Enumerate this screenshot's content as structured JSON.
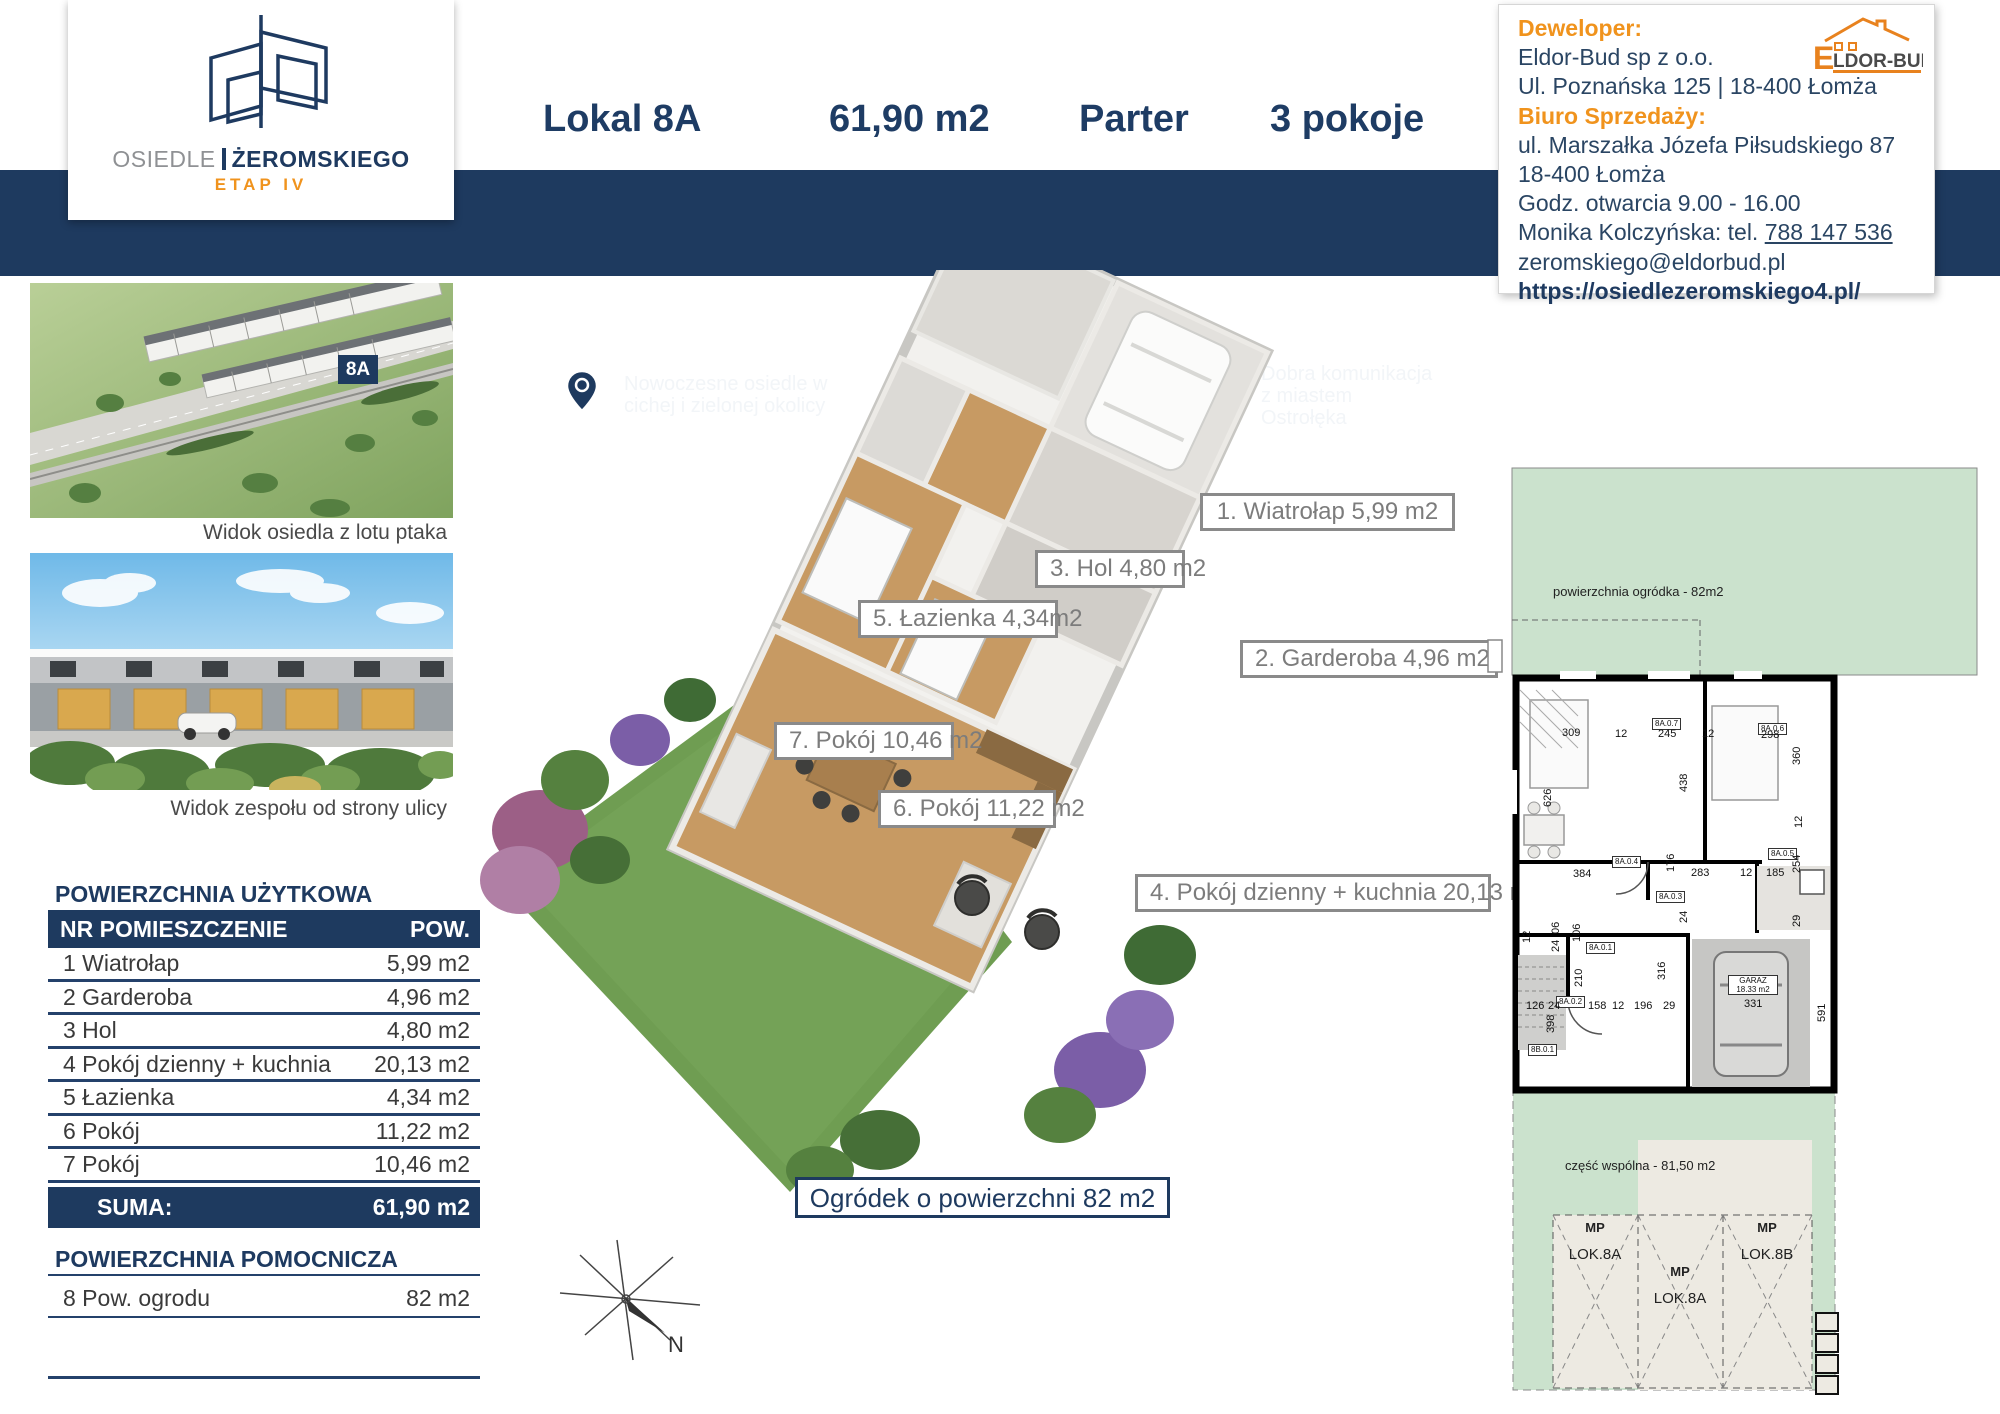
{
  "logo": {
    "line_gray": "OSIEDLE",
    "line_navy": "ŻEROMSKIEGO",
    "etap": "ETAP IV"
  },
  "header": {
    "lokal": "Lokal 8A",
    "area": "61,90 m2",
    "floor": "Parter",
    "rooms": "3 pokoje"
  },
  "features": [
    {
      "icon": "location-pin-icon",
      "text": "Nowoczesne osiedle w cichej i zielonej okolicy"
    },
    {
      "icon": "floorplan-icon",
      "text": "Zróżnicowane warianty lokali"
    },
    {
      "icon": "building-icon",
      "text": "Dobra komunikacja z miastem Ostrołęka"
    }
  ],
  "developer_box": {
    "dev_label": "Deweloper:",
    "dev_name": "Eldor-Bud  sp z o.o.",
    "dev_address": "Ul. Poznańska 125 | 18-400 Łomża",
    "office_label": "Biuro Sprzedaży:",
    "office_address1": "ul. Marszałka Józefa Piłsudskiego 87",
    "office_address2": "18-400 Łomża",
    "hours": "Godz. otwarcia 9.00 - 16.00",
    "contact_prefix": "Monika Kolczyńska: tel. ",
    "phone": "788 147 536",
    "email": " zeromskiego@eldorbud.pl",
    "website": "https://osiedlezeromskiego4.pl/",
    "brand_e": "E",
    "brand_rest": "LDOR-BUD"
  },
  "photos": {
    "badge": "8A",
    "caption1": "Widok osiedla z lotu ptaka",
    "caption2": "Widok zespołu od strony ulicy"
  },
  "area_table": {
    "title": "POWIERZCHNIA UŻYTKOWA",
    "col_nr": "NR POMIESZCZENIE",
    "col_pow": "POW.",
    "rows": [
      {
        "name": "1 Wiatrołap",
        "pow": "5,99 m2"
      },
      {
        "name": "2 Garderoba",
        "pow": "4,96 m2"
      },
      {
        "name": "3 Hol",
        "pow": "4,80 m2"
      },
      {
        "name": "4  Pokój dzienny + kuchnia",
        "pow": "20,13 m2"
      },
      {
        "name": "5 Łazienka",
        "pow": "4,34 m2"
      },
      {
        "name": "6 Pokój",
        "pow": "11,22 m2"
      },
      {
        "name": "7 Pokój",
        "pow": "10,46 m2"
      }
    ],
    "suma_label": "SUMA:",
    "suma_value": "61,90 m2"
  },
  "aux_table": {
    "title": "POWIERZCHNIA POMOCNICZA",
    "row_name": "8  Pow. ogrodu",
    "row_pow": "82 m2"
  },
  "plan3d": {
    "labels": [
      {
        "text": "1. Wiatrołap 5,99 m2"
      },
      {
        "text": "3.  Hol 4,80 m2"
      },
      {
        "text": "5. Łazienka 4,34m2"
      },
      {
        "text": "2. Garderoba 4,96 m2"
      },
      {
        "text": "7. Pokój 10,46 m2"
      },
      {
        "text": "6. Pokój 11,22 m2"
      },
      {
        "text": "4. Pokój dzienny + kuchnia 20,13 m2"
      }
    ],
    "garden_box": "Ogródek o powierzchni 82 m2"
  },
  "compass": {
    "north": "N"
  },
  "plan2d": {
    "garden_text": "powierzchnia ogródka - 82m2",
    "common_text": "część wspólna - 81,50 m2",
    "garage_name": "GARAZ",
    "garage_area": "18.33 m2",
    "room_codes": [
      "8A.0.7",
      "8A.0.6",
      "8A.0.5",
      "8A.0.4",
      "8A.0.3",
      "8A.0.2",
      "8A.0.1",
      "8B.0.1"
    ],
    "dims": [
      "309",
      "12",
      "245",
      "12",
      "298",
      "360",
      "438",
      "626",
      "176",
      "283",
      "12",
      "185",
      "254",
      "12",
      "384",
      "24",
      "29",
      "12",
      "06",
      "24",
      "106",
      "210",
      "126",
      "24",
      "158",
      "12",
      "196",
      "29",
      "398",
      "316",
      "331",
      "591"
    ],
    "parking": [
      {
        "mp": "MP",
        "lok": "LOK.8A"
      },
      {
        "mp": "MP",
        "lok": "LOK.8A"
      },
      {
        "mp": "MP",
        "lok": "LOK.8B"
      }
    ]
  },
  "colors": {
    "navy": "#1e3a5f",
    "orange": "#f0931d",
    "plan_green": "#cbe2cd",
    "lawn": "#6f9d52"
  }
}
